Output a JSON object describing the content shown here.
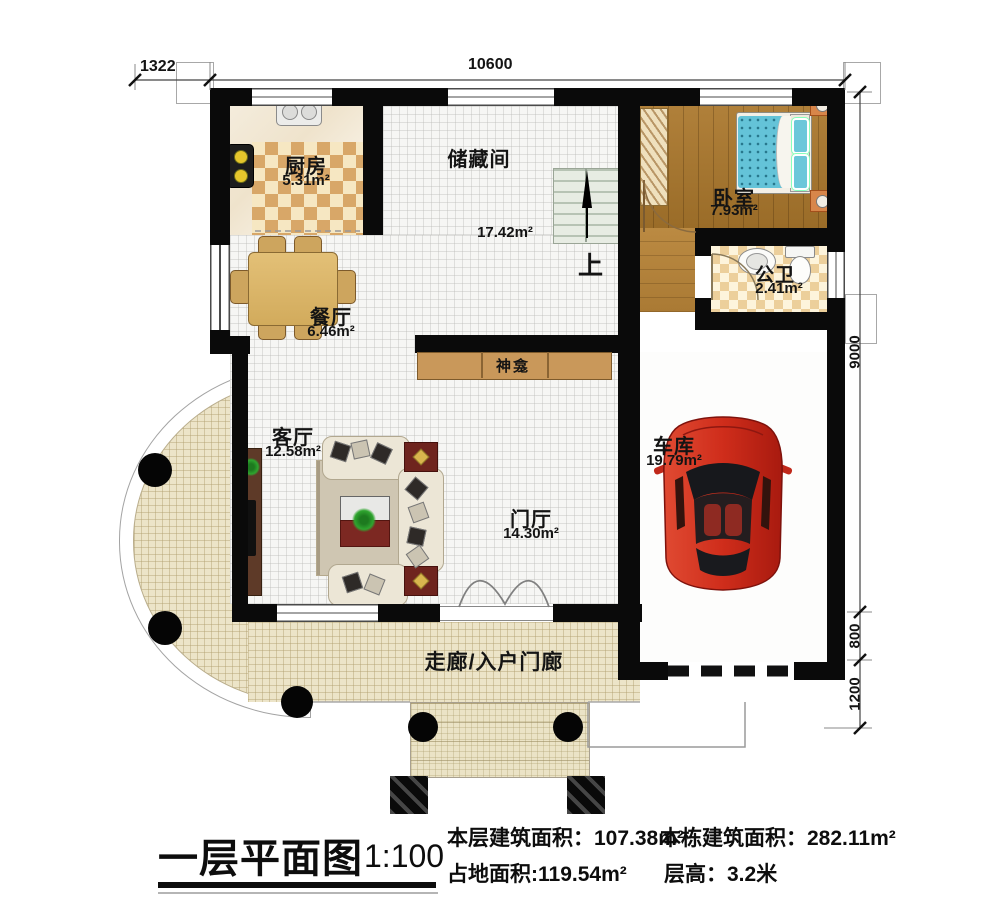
{
  "plan": {
    "rooms": {
      "kitchen": {
        "name": "厨房",
        "area": "5.31m²"
      },
      "storage": {
        "name": "储藏间",
        "area": "17.42m²"
      },
      "bedroom": {
        "name": "卧室",
        "area": "7.93m²"
      },
      "bathroom": {
        "name": "公卫",
        "area": "2.41m²"
      },
      "dining": {
        "name": "餐厅",
        "area": "6.46m²"
      },
      "living": {
        "name": "客厅",
        "area": "12.58m²"
      },
      "entry": {
        "name": "门厅",
        "area": "14.30m²"
      },
      "garage": {
        "name": "车库",
        "area": "19.79m²"
      },
      "corridor": {
        "name": "走廊/入户门廊"
      },
      "shrine": {
        "name": "神龛"
      },
      "stairs": {
        "direction_label": "上"
      }
    },
    "dimensions": {
      "top_left_offset": "1322",
      "top_width": "10600",
      "right_height": "9000",
      "right_offset_small": "800",
      "right_offset_large": "1200"
    }
  },
  "legend": {
    "title": "一层平面图",
    "scale": "1:100",
    "stats": [
      {
        "label": "本层建筑面积：",
        "value": "107.38m²"
      },
      {
        "label": "本栋建筑面积：",
        "value": "282.11m²"
      },
      {
        "label": "占地面积:",
        "value": "119.54m²"
      },
      {
        "label": "层高：",
        "value": "3.2米"
      }
    ]
  },
  "colors": {
    "wall": "#0a0a0a",
    "car_red": "#c4281c",
    "bed_teal": "#64c3d8",
    "checker_tan": "#d8a768",
    "terrace_beige": "#ece4c8",
    "wood_brown": "#a9762f"
  }
}
